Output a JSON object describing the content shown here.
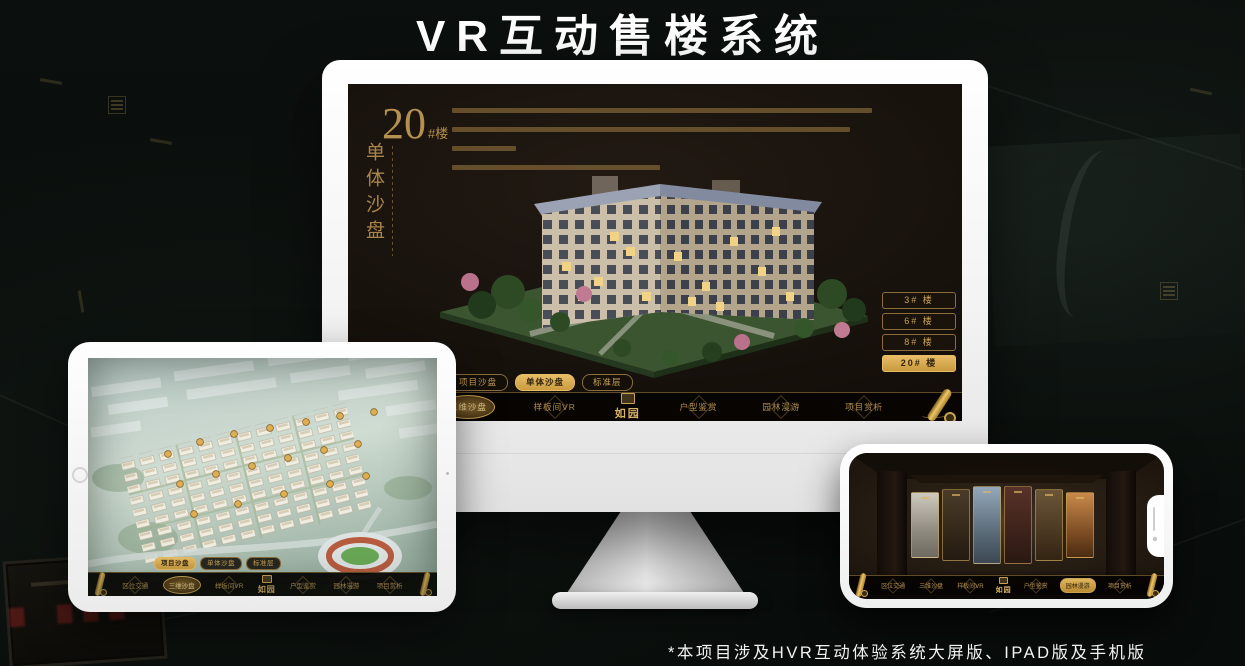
{
  "page": {
    "title": "VR互动售楼系统",
    "footnote": "*本项目涉及HVR互动体验系统大屏版、IPAD版及手机版"
  },
  "colors": {
    "accent_gold": "#c9a254",
    "highlight_gold": "#d8a94e",
    "screen_background": "#140f0a"
  },
  "shared": {
    "logo": "如园",
    "sub_tabs": [
      "项目沙盘",
      "单体沙盘",
      "标准层"
    ],
    "menu": [
      "区位交通",
      "三维沙盘",
      "样板间VR",
      "户型鉴赏",
      "园林漫游",
      "项目赏析"
    ]
  },
  "monitor": {
    "unit_number": "20",
    "unit_suffix": "#楼",
    "unit_name": "单体沙盘",
    "floor_buttons": [
      "3# 楼",
      "6# 楼",
      "8# 楼",
      "20# 楼"
    ]
  }
}
